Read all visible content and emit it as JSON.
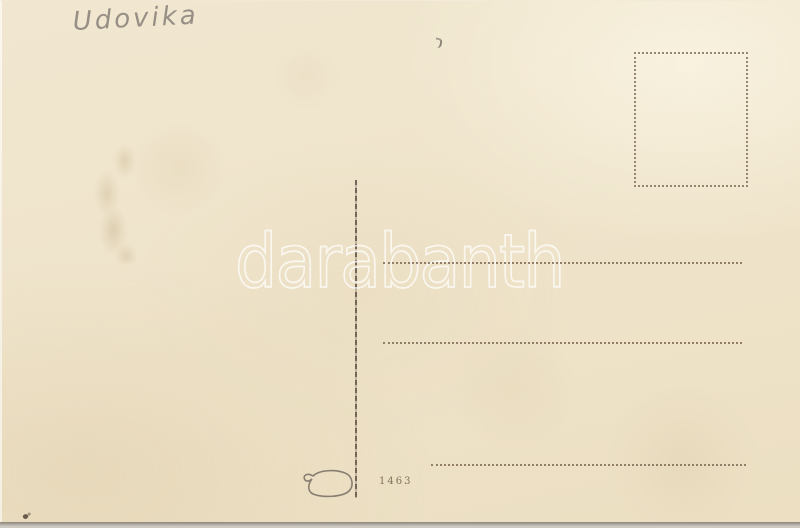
{
  "postcard": {
    "handwriting_text": "Udovika",
    "plate_number": "1463",
    "watermark_text": "darabanth",
    "address_line_count": 3,
    "colors": {
      "card_paper": "#efe4cb",
      "background": "#c9c6bf",
      "printed_ink": "#7a6552",
      "pencil": "#78726c",
      "watermark": "#ffffff"
    }
  }
}
